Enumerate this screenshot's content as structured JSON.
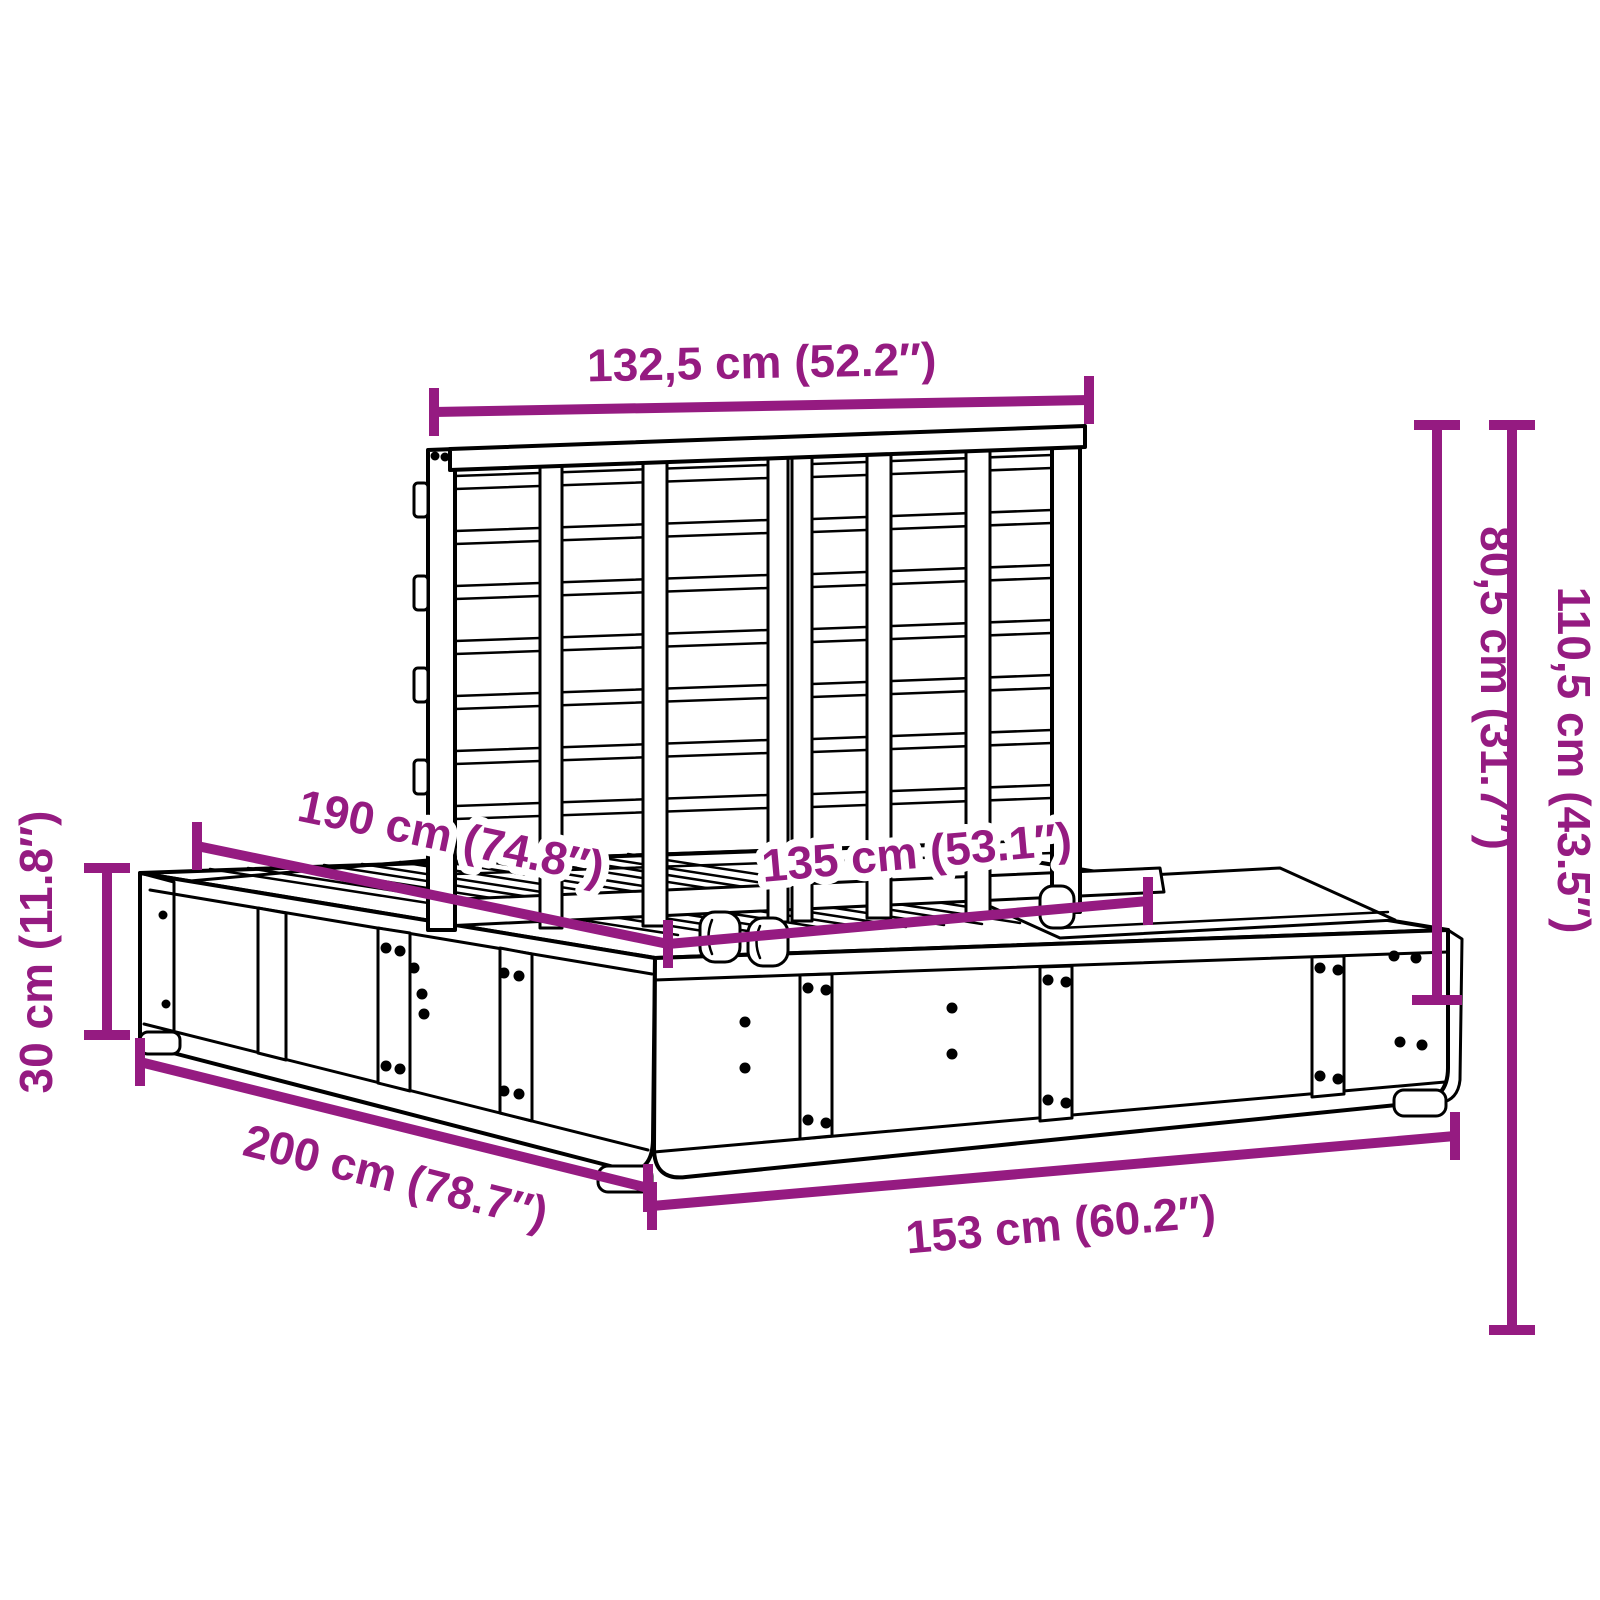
{
  "diagram": {
    "type": "product-dimension-diagram",
    "subject": "platform bed frame with slatted headboard",
    "accent_color": "#951B81",
    "line_color": "#000000",
    "background_color": "#FFFFFF",
    "dimensions": {
      "headboard_width": "132,5 cm (52.2″)",
      "headboard_height_above_base": "80,5 cm (31.7″)",
      "total_height": "110,5 cm (43.5″)",
      "base_height": "30 cm (11.8″)",
      "inner_length": "190 cm (74.8″)",
      "inner_width": "135 cm (53.1″)",
      "total_length": "200 cm (78.7″)",
      "total_width": "153 cm (60.2″)"
    }
  }
}
